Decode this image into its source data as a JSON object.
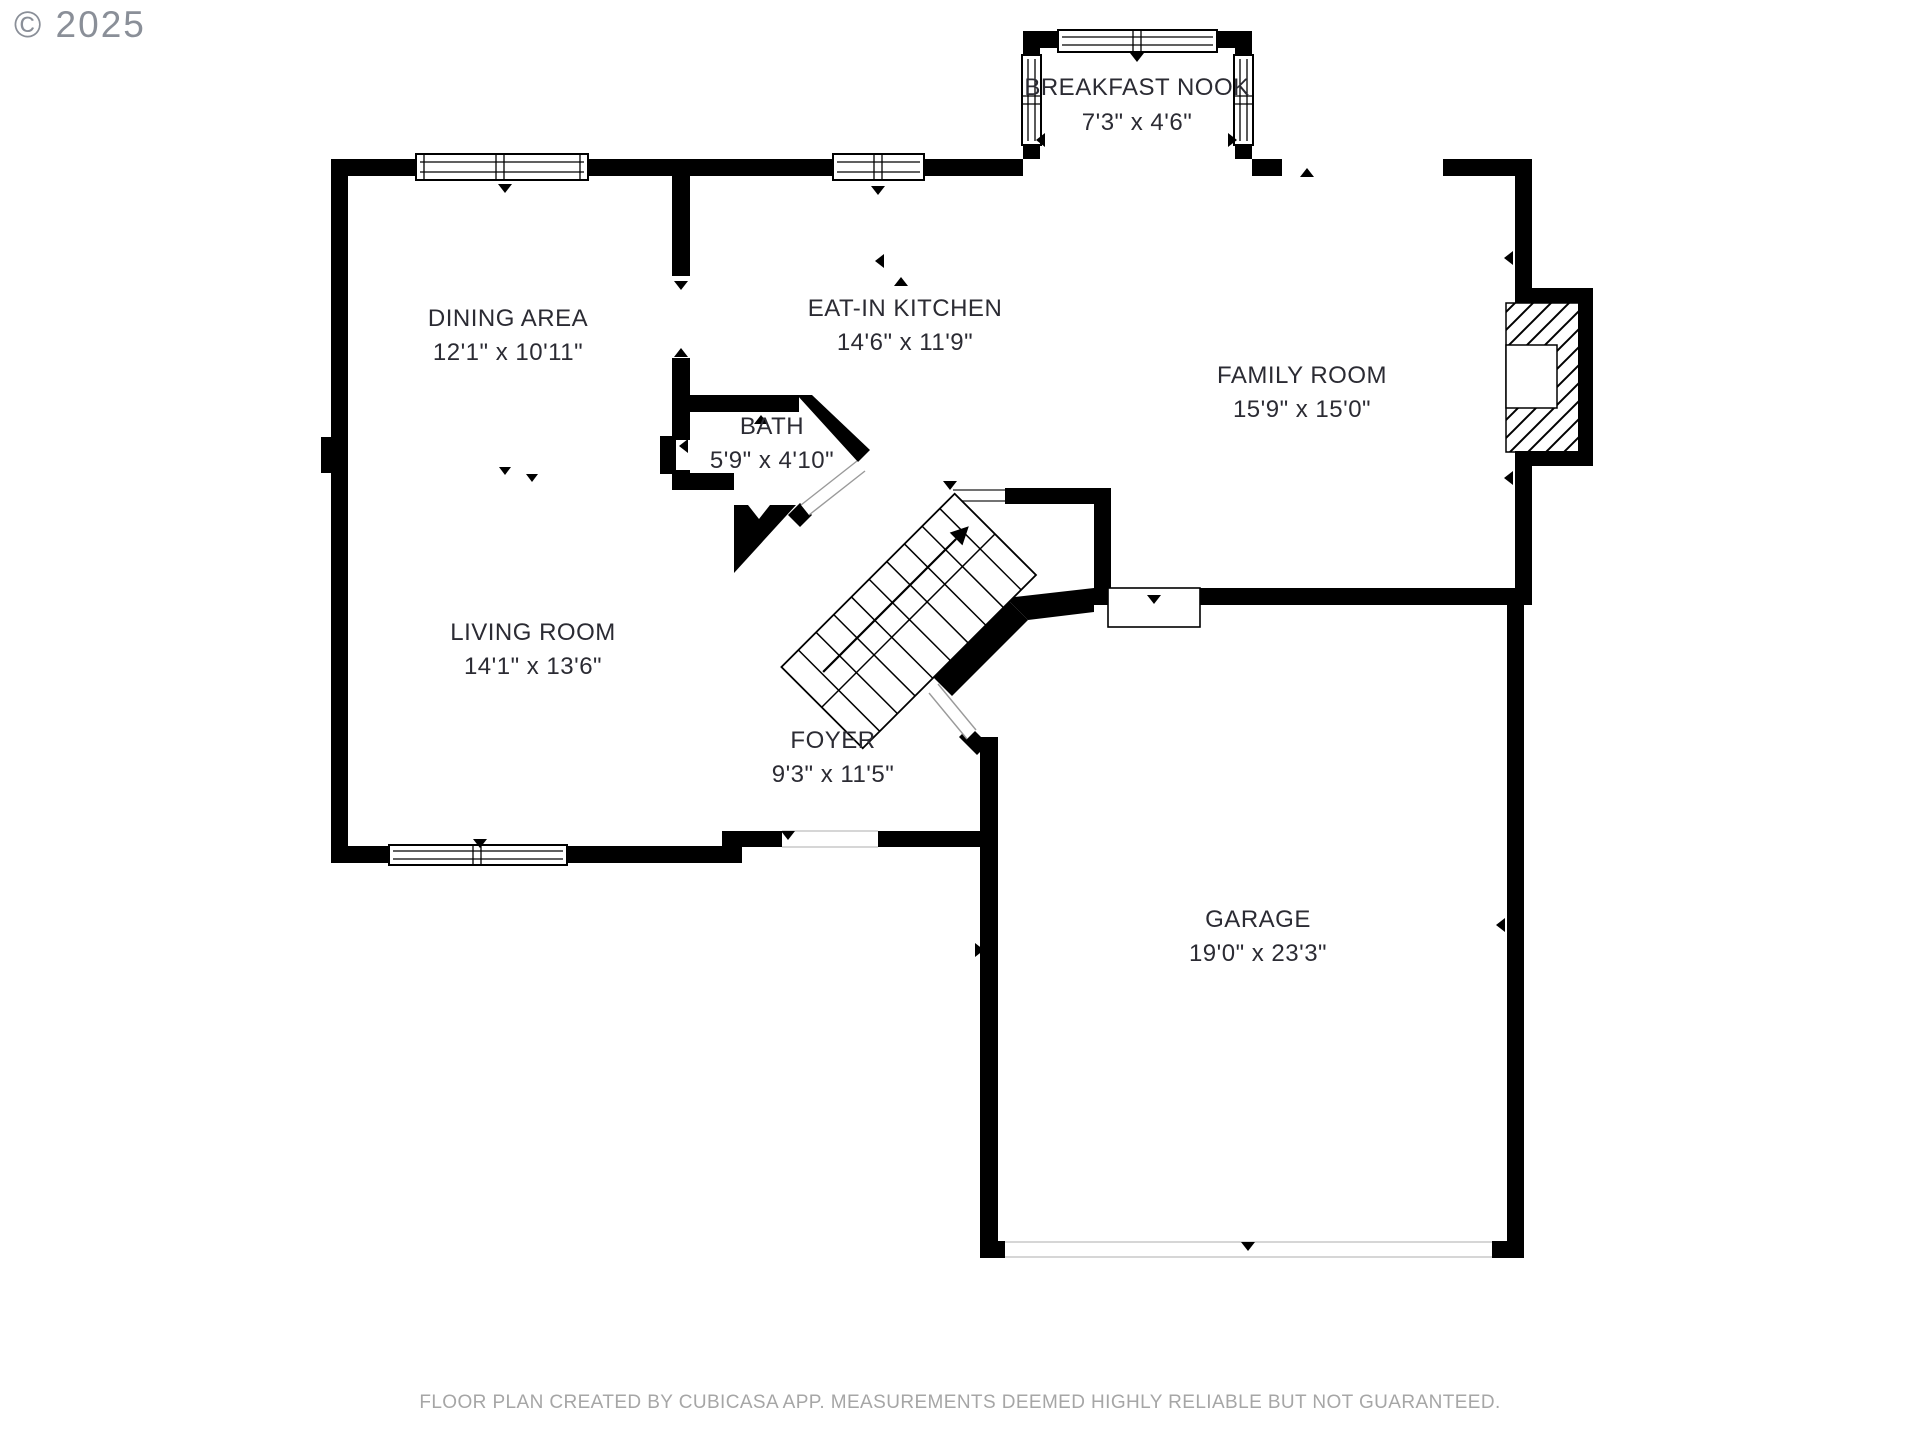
{
  "copyright": "© 2025",
  "footer": "FLOOR PLAN CREATED BY CUBICASA APP. MEASUREMENTS DEEMED HIGHLY RELIABLE BUT NOT GUARANTEED.",
  "rooms": [
    {
      "id": "breakfast-nook",
      "name": "BREAKFAST NOOK",
      "dimensions": "7'3\" x 4'6\""
    },
    {
      "id": "dining-area",
      "name": "DINING AREA",
      "dimensions": "12'1\" x 10'11\""
    },
    {
      "id": "eat-in-kitchen",
      "name": "EAT-IN KITCHEN",
      "dimensions": "14'6\" x 11'9\""
    },
    {
      "id": "family-room",
      "name": "FAMILY ROOM",
      "dimensions": "15'9\" x 15'0\""
    },
    {
      "id": "bath",
      "name": "BATH",
      "dimensions": "5'9\" x 4'10\""
    },
    {
      "id": "living-room",
      "name": "LIVING ROOM",
      "dimensions": "14'1\" x 13'6\""
    },
    {
      "id": "foyer",
      "name": "FOYER",
      "dimensions": "9'3\" x 11'5\""
    },
    {
      "id": "garage",
      "name": "GARAGE",
      "dimensions": "19'0\" x 23'3\""
    }
  ],
  "features": {
    "stairs": "staircase-up-arrow",
    "fireplace": "hatched-fireplace-with-firebox",
    "doors": [
      "front-door",
      "garage-vehicle-door",
      "garage-entry-door",
      "bath-door",
      "foyer-garage-door"
    ],
    "windows": [
      "dining-window",
      "kitchen-window",
      "nook-top-window",
      "nook-left-window",
      "nook-right-window",
      "living-room-window"
    ]
  },
  "colors": {
    "wall": "#000000",
    "room_label": "#2b2b33",
    "copyright": "#8a8f98",
    "footer": "#a6a6a6",
    "background": "#ffffff"
  }
}
